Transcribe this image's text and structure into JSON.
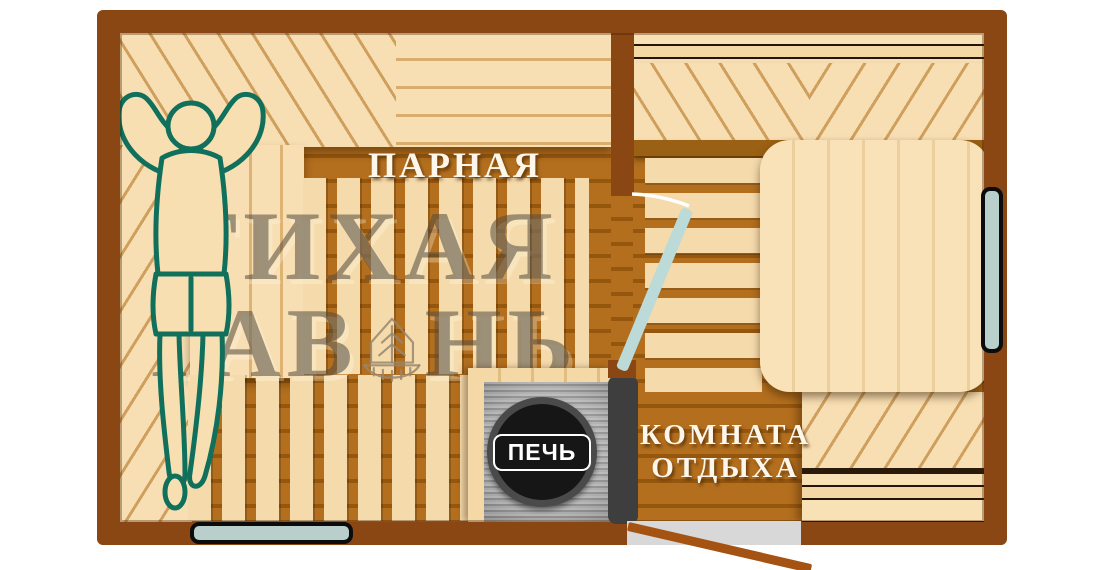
{
  "plan": {
    "title": "Sauna floor plan",
    "steam_room_label": "ПАРНАЯ",
    "stove_label": "ПЕЧЬ",
    "rest_room_label_line1": "КОМНАТА",
    "rest_room_label_line2": "ОТДЫХА"
  },
  "watermark": {
    "line1": "ТИХАЯ",
    "line2_before": "ГАВ",
    "line2_after": "НЬ"
  },
  "colors": {
    "wall_frame": "#8a4713",
    "floor_dark": "#a96518",
    "wood_light": "#f6dcae",
    "interior_door": "#bcdad8",
    "window_fill": "#b9cfcb",
    "stove_metal": "#c6c6c6",
    "stove_burner": "#161616",
    "heat_shield": "#3e3e3e",
    "person_outline": "#10705c",
    "person_fill": "#f8dfb2",
    "room_label_text": "#fdf6ea",
    "watermark_text": "#52493d"
  }
}
